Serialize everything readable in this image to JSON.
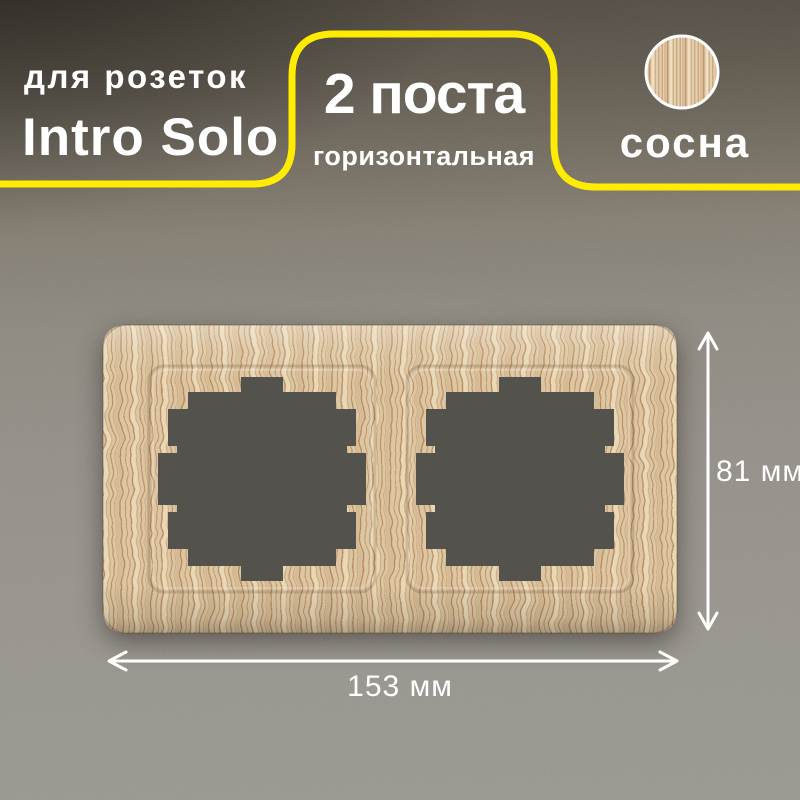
{
  "card": {
    "product_type": "для розеток",
    "product_name": "Intro Solo",
    "badge": {
      "title": "2 поста",
      "subtitle": "горизонтальная"
    },
    "material": {
      "name": "сосна",
      "swatch_icon": "pine-wood-circle-icon"
    },
    "dimensions": {
      "height": "81 мм",
      "width": "153 мм"
    },
    "colors": {
      "accent_yellow": "#ffec00",
      "text": "#ffffff",
      "wood_base": "#ddc7a3",
      "wood_grain": "#b98e62",
      "socket_opening_gray": "#54524c",
      "wall_gray": "#94908a",
      "header_dark": "#2f2b24"
    }
  }
}
